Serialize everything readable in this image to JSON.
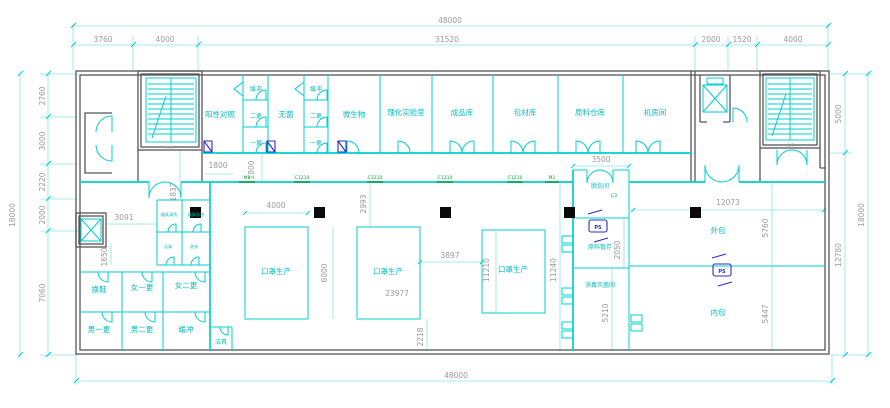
{
  "colors": {
    "line_cyan": "#00cfcf",
    "dim_line_pale": "#8ce5e5",
    "dim_text_gray": "#9b9b9b",
    "wall_gray": "#565656",
    "label_cyan": "#00bdbd",
    "tag_green": "#00a33c",
    "symbol_navy": "#2b2bd0",
    "column_black": "#0a0a0a",
    "background": "#ffffff"
  },
  "dims": {
    "total_w_top": "48000",
    "total_w_bottom": "48000",
    "t3760": "3760",
    "t4000a": "4000",
    "t31520": "31520",
    "t2000": "2000",
    "t1520": "1520",
    "t4000b": "4000",
    "l18000": "18000",
    "l2760": "2760",
    "l3000": "3000",
    "l2220": "2220",
    "l2000": "2000",
    "l7060": "7060",
    "r5000": "5000",
    "r12780": "12780",
    "r18000": "18000",
    "i1800h": "1800",
    "i1800v": "1800",
    "i1837": "1837",
    "i3091": "3091",
    "i1650": "1650",
    "i4000": "4000",
    "i6000": "6000",
    "i23977": "23977",
    "i2993": "2993",
    "i3897": "3897",
    "i11210": "11210",
    "i11240": "11240",
    "i2218": "2218",
    "i3500": "3500",
    "i2050": "2050",
    "i5210": "5210",
    "i12073": "12073",
    "i5760": "5760",
    "i5447": "5447"
  },
  "rooms": {
    "positive_control": "阳性对照",
    "buffer1": "缓冲",
    "second_change1": "二更",
    "first_change1": "一更",
    "sterile": "无菌",
    "buffer2": "缓冲",
    "second_change2": "二更",
    "first_change2": "一更",
    "microbiology": "微生物",
    "physchem_lab": "理化实验室",
    "finished_goods": "成品库",
    "packaging_material": "包材库",
    "raw_material_wh": "原料仓库",
    "machine_room": "机房间",
    "tool_wash": "器具清洗",
    "tool_store": "器具存放",
    "util_a": "洁具",
    "util_b": "洗衣",
    "shoe_change": "换鞋",
    "female_first": "女一更",
    "female_second": "女二更",
    "male_first": "男一更",
    "male_second": "男二更",
    "buffer3": "缓冲",
    "cleaning_tools": "洁具",
    "mask_prod1": "口罩生产",
    "mask_prod2": "口罩生产",
    "mask_prod3": "口罩生产",
    "depack": "脱包间",
    "raw_temp": "原料暂存",
    "sterilization": "消毒灭菌间",
    "outer_pack": "外包",
    "inner_pack": "内包"
  },
  "tags": {
    "t1": "M5",
    "t2": "C1210",
    "t3": "C1210",
    "t4": "C1210",
    "t5": "C1210",
    "t6": "M1",
    "t7": "C3"
  },
  "symbols": {
    "ps": "PS"
  },
  "stairs": {
    "left_mark": "2 3",
    "right_mark": "1 7"
  }
}
